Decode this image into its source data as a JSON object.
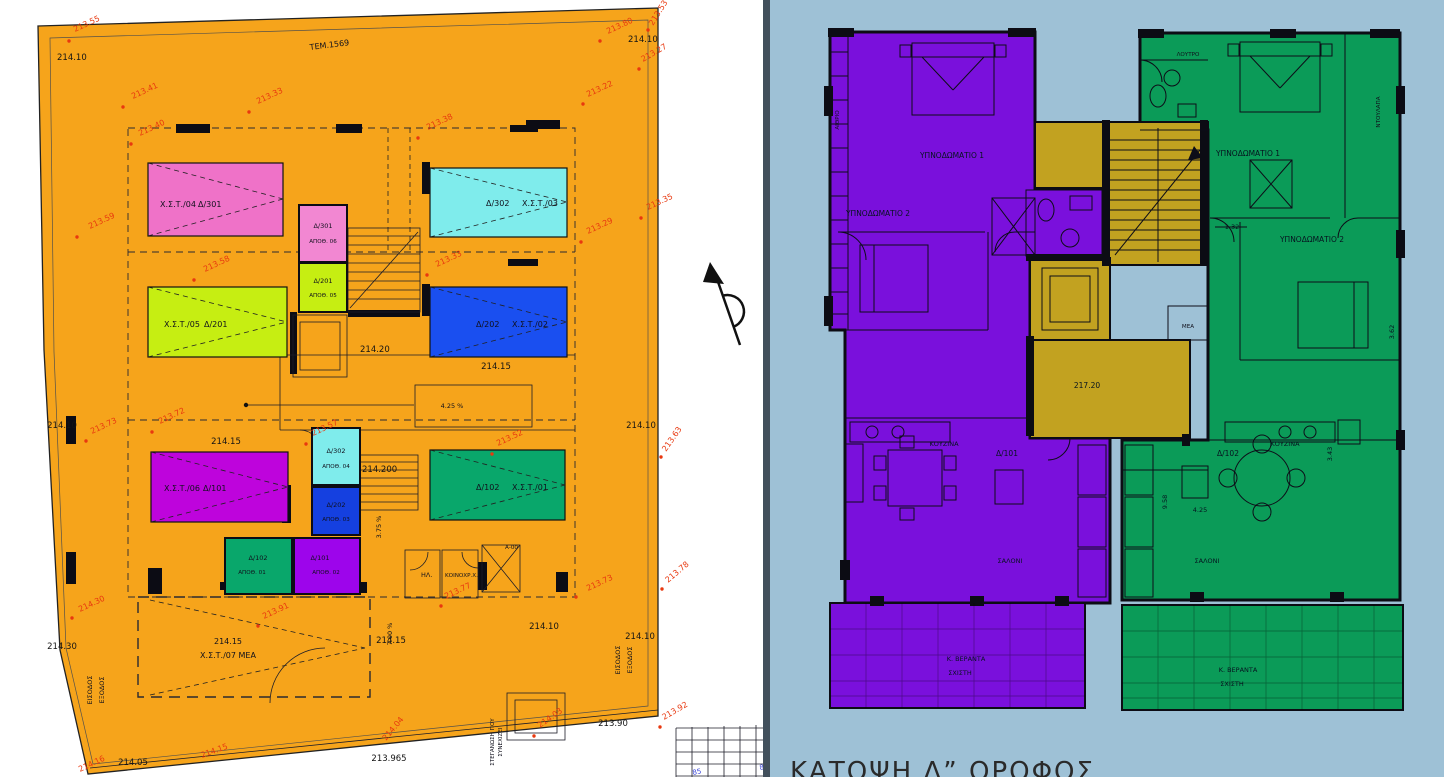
{
  "left_plan": {
    "background_color": "#F6A41B",
    "annotation_color": "#E8380F",
    "parcel_label": "ΤΕΜ.1569",
    "parking_spaces": [
      {
        "label_a": "Χ.Σ.Τ./04",
        "label_b": "Δ/301",
        "color": "#EF72C8"
      },
      {
        "label_a": "Δ/302",
        "label_b": "Χ.Σ.Τ./03",
        "color": "#7FECEC"
      },
      {
        "label_a": "Χ.Σ.Τ./05",
        "label_b": "Δ/201",
        "color": "#C6EE12"
      },
      {
        "label_a": "Δ/202",
        "label_b": "Χ.Σ.Τ./02",
        "color": "#1A4FF0"
      },
      {
        "label_a": "Χ.Σ.Τ./06",
        "label_b": "Δ/101",
        "color": "#BE04DC"
      },
      {
        "label_a": "Δ/102",
        "label_b": "Χ.Σ.Τ./01",
        "color": "#09A76B"
      }
    ],
    "mea_parking": {
      "line1": "214.15",
      "line2": "Χ.Σ.Τ./07 ΜΕΑ"
    },
    "storerooms": [
      {
        "code": "Δ/301",
        "name": "ΑΠΟΘ. 06",
        "color": "#F287D2"
      },
      {
        "code": "Δ/201",
        "name": "ΑΠΟΘ. 05",
        "color": "#C6EE12"
      },
      {
        "code": "Δ/302",
        "name": "ΑΠΟΘ. 04",
        "color": "#7FECEC"
      },
      {
        "code": "Δ/202",
        "name": "ΑΠΟΘ. 03",
        "color": "#1540E0"
      },
      {
        "code": "Δ/102",
        "name": "ΑΠΟΘ. 01",
        "color": "#09A76B"
      },
      {
        "code": "Δ/101",
        "name": "ΑΠΟΘ. 02",
        "color": "#9D05EB"
      }
    ],
    "rooms": {
      "electrical": "ΗΛ.",
      "communal": "ΚΟΙΝΟΧΡ.Χ.",
      "shaft_tag": "Α-00"
    },
    "levels": {
      "top_left": "214.10",
      "top_right": "214.10",
      "core": "214.20",
      "core_lower": "214.200",
      "mid_left": "214.15",
      "below_blue": "214.15",
      "bottom_center": "214.15",
      "bottom_a": "214.10",
      "bottom_b": "214.10",
      "right_edge": "214.10",
      "left_edge": "214.10",
      "left_edge_low": "214.30",
      "slab_edge": "213.965",
      "street_edge": "213.90",
      "street_left": "214.05"
    },
    "spot_elevations": [
      "213.55",
      "213.41",
      "213.33",
      "213.40",
      "213.59",
      "213.58",
      "213.38",
      "213.35",
      "213.29",
      "213.33",
      "213.53",
      "213.80",
      "213.27",
      "213.22",
      "213.72",
      "213.73",
      "213.57",
      "213.52",
      "213.63",
      "213.73",
      "213.78",
      "213.91",
      "213.77",
      "214.03",
      "213.92",
      "214.30",
      "214.16",
      "214.15",
      "214.04"
    ],
    "ramps": {
      "main": "4.25 %",
      "side": "3.75 %",
      "street": "7.00 %"
    },
    "entrance": {
      "line1": "ΕΙΣΟΔΟΣ",
      "line2": "ΕΞΟΔΟΣ"
    },
    "note": {
      "line1": "ΣΤΕΓΑΝΩΣΗ ΠΟΥ",
      "line2": "ΣΥΝΕΧΙΖΕΙ"
    },
    "survey_marks": [
      "85",
      "85"
    ]
  },
  "right_plan": {
    "background_color": "#9EC1D6",
    "title": "ΚΑΤΟΨΗ Δ” ΟΡΟΦΟΣ",
    "core": {
      "color": "#C2A220",
      "level": "217.20",
      "mea": "ΜΕΑ"
    },
    "apartment_left": {
      "code": "Δ/101",
      "color": "#7A10DC",
      "bedroom1": "ΥΠΝΟΔΩΜΑΤΙΟ 1",
      "bedroom2": "ΥΠΝΟΔΩΜΑΤΙΟ 2",
      "kitchen": "ΚΟΥΖΙΝΑ",
      "living": "ΣΑΛΟΝΙ",
      "veranda1": "Κ. ΒΕΡΑΝΤΑ",
      "veranda2": "ΣΧΙΣΤΗ",
      "atrium": "ΑΙΘΡΙΟ"
    },
    "apartment_right": {
      "code": "Δ/102",
      "color": "#0B9B58",
      "bedroom1": "ΥΠΝΟΔΩΜΑΤΙΟ 1",
      "bedroom2": "ΥΠΝΟΔΩΜΑΤΙΟ 2",
      "kitchen": "ΚΟΥΖΙΝΑ",
      "living": "ΣΑΛΟΝΙ",
      "veranda1": "Κ. ΒΕΡΑΝΤΑ",
      "veranda2": "ΣΧΙΣΤΗ",
      "bathroom": "ΛΟΥΤΡΟ",
      "closet": "ΝΤΟΥΛΑΠΑ"
    },
    "dimensions": [
      "1.32",
      "4.25",
      "9.58",
      "3.43",
      "3.62"
    ]
  }
}
